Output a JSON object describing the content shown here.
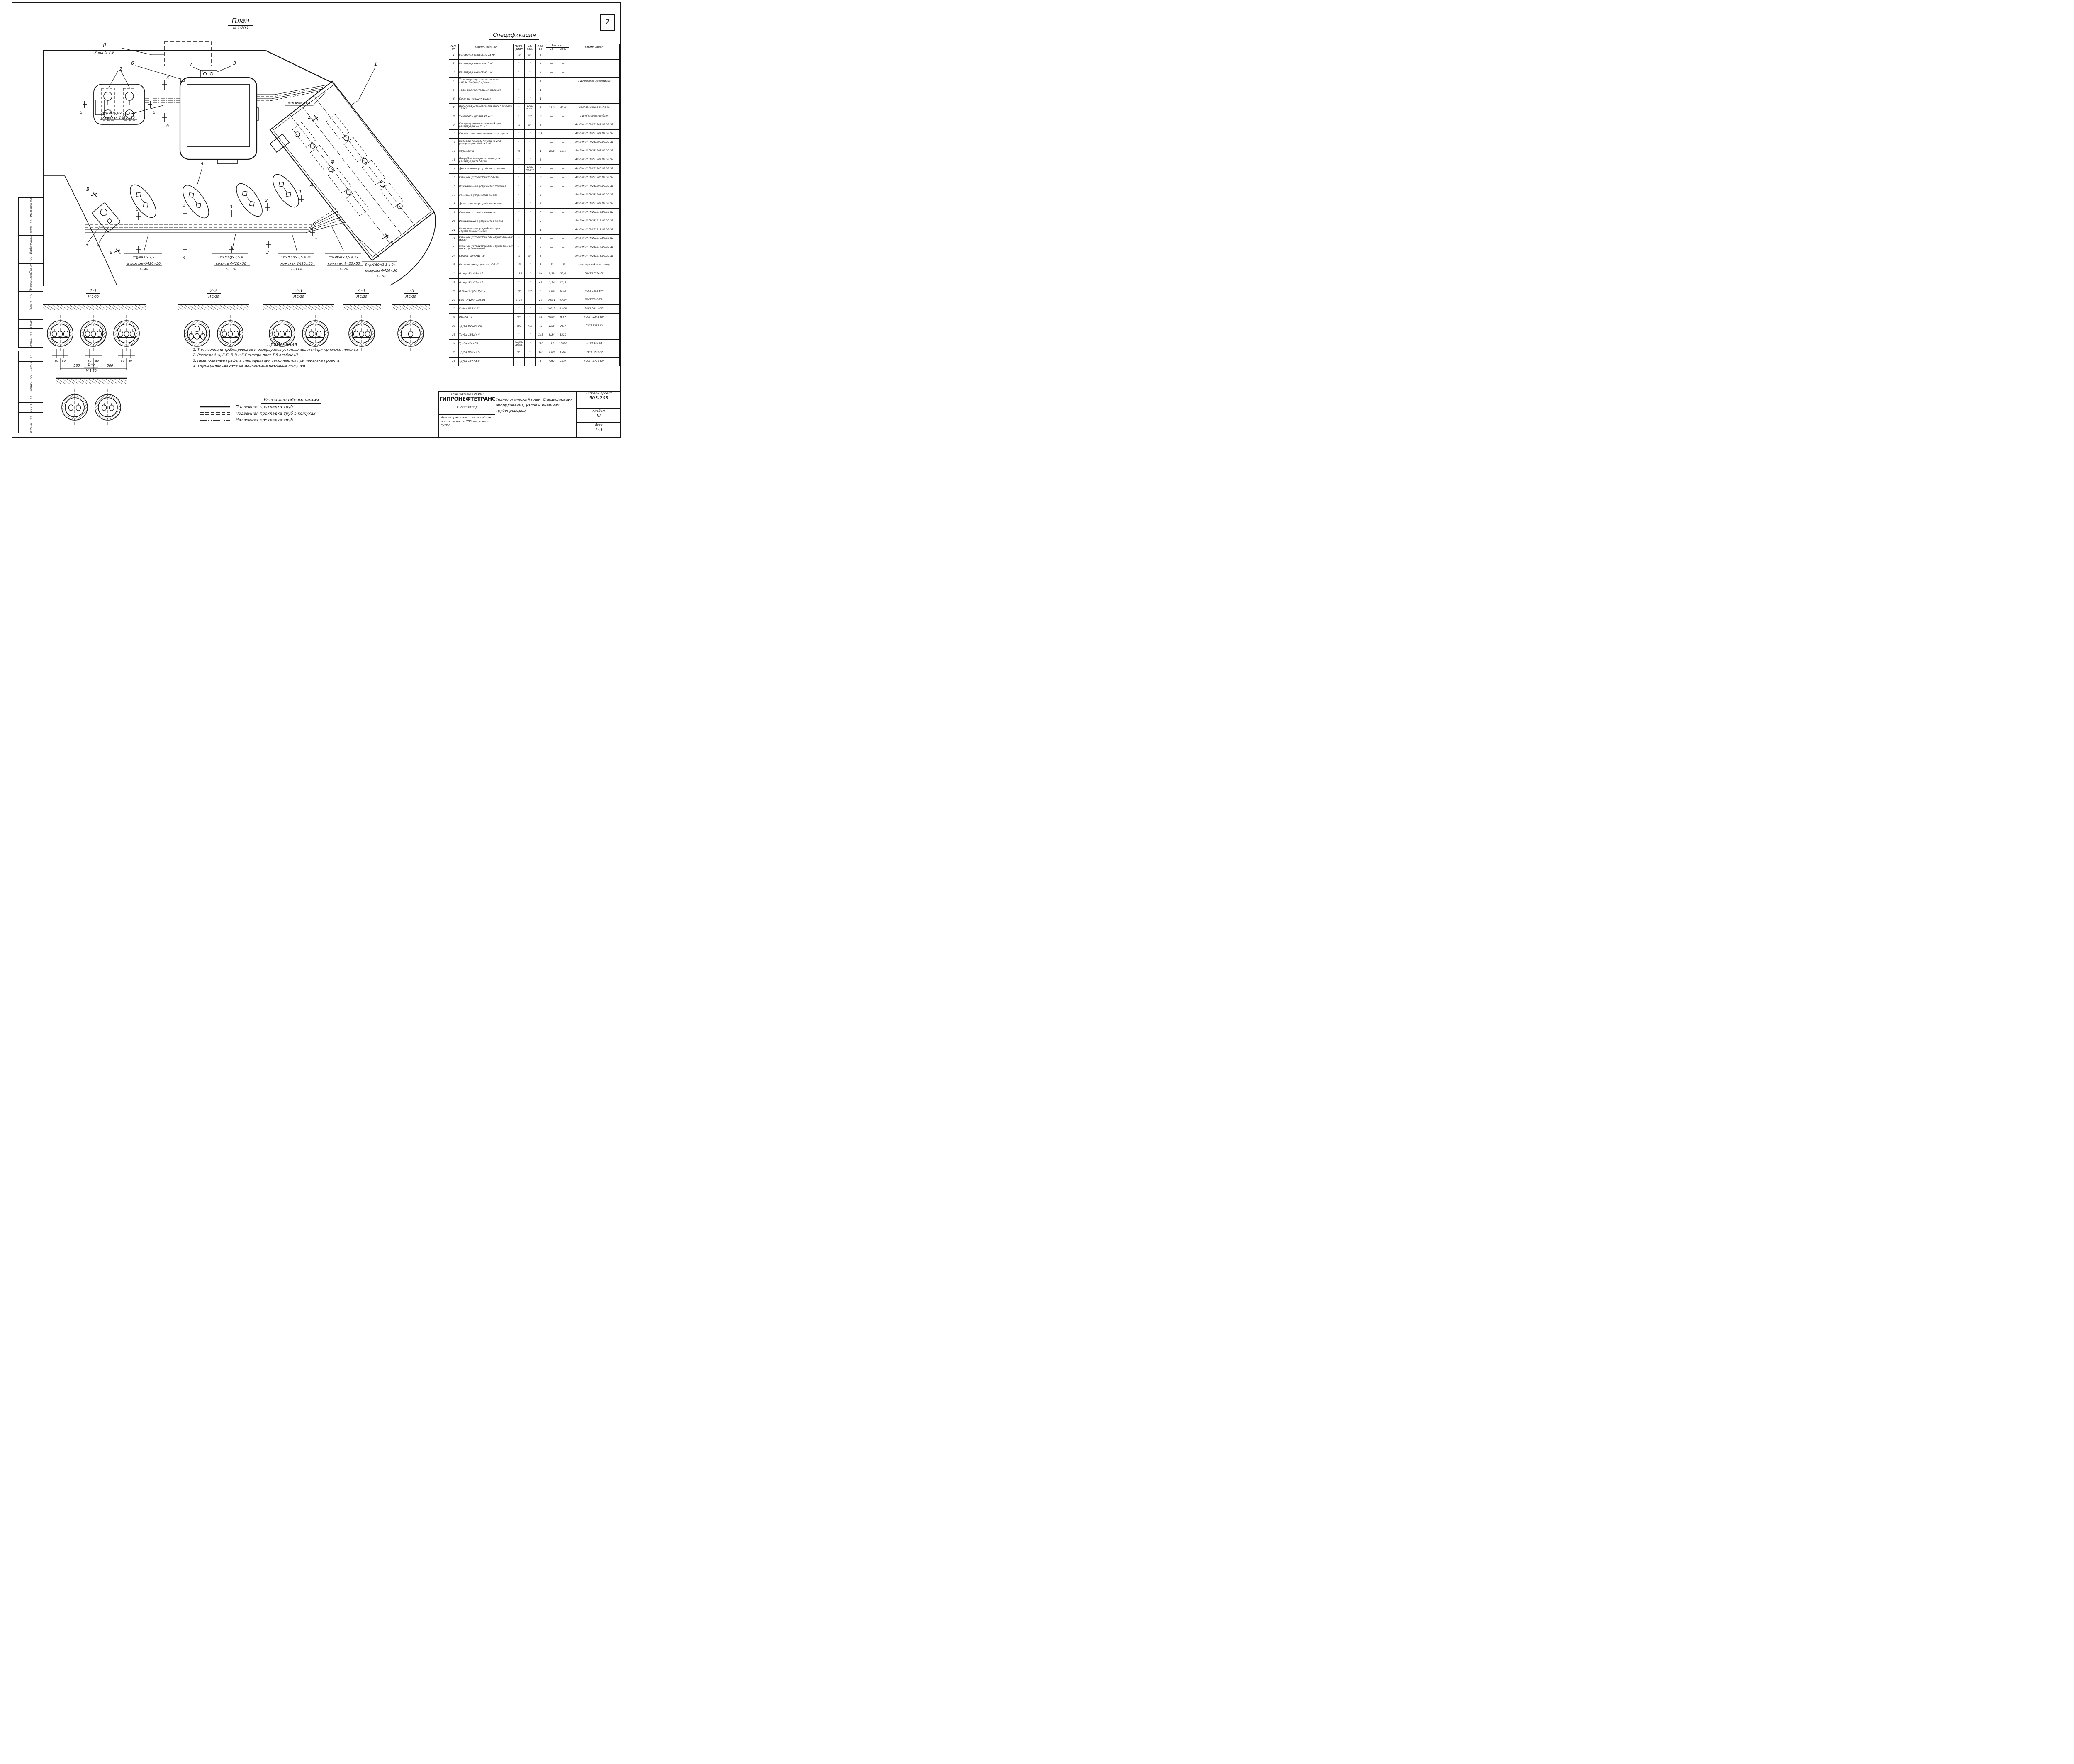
{
  "page": {
    "number": "7"
  },
  "plan": {
    "title": "План",
    "scale": "М 1:200",
    "zone": {
      "num": "II",
      "name": "Зона А, Г-Б"
    },
    "labels": {
      "tr4_1": "4тр.Ф26,8×2,8 в 2х",
      "tr4_2": "кожухах Ф420×50",
      "tr8": "8тр.Ф88,5×4",
      "tr1_1": "1тр.Ф60×3,5",
      "tr1_2": "в кожухе Ф420×50",
      "tr1_3": "ℓ=9м",
      "tr3_1": "3тр Ф60×3,5 в",
      "tr3_2": "кожухе Ф420×50",
      "tr3_3": "ℓ=11м",
      "tr5_1": "5тр Ф60×3,5 в 2х",
      "tr5_2": "кожухах Ф420×50",
      "tr5_3": "ℓ=11м",
      "tr7_1": "7тр.Ф60×3,5 в 2х",
      "tr7_2": "кожухах Ф420×50",
      "tr7_3": "ℓ=7м",
      "tr9_1": "9тр.Ф60×3,5 в 2х",
      "tr9_2": "кожухах Ф420×50",
      "tr9_3": "ℓ=7м"
    },
    "callouts": {
      "n1": "1",
      "n2": "2",
      "n3": "3",
      "n4": "4",
      "n5": "5",
      "n6": "6",
      "n7": "7"
    },
    "markers": {
      "a": "А",
      "b": "Б",
      "v": "В",
      "d": "Д",
      "s1": "1",
      "s2": "2",
      "s3": "3",
      "s4": "4",
      "s5": "5",
      "s6": "6"
    }
  },
  "sections": [
    {
      "id": "1-1",
      "scale": "М 1:20",
      "casings": [
        [
          3
        ],
        [
          3
        ],
        [
          3
        ]
      ],
      "dims": {
        "pair": [
          "80",
          "80"
        ],
        "span": "580"
      }
    },
    {
      "id": "2-2",
      "scale": "М 1:20",
      "casings": [
        [
          1,
          3
        ],
        [
          3
        ]
      ]
    },
    {
      "id": "3-3",
      "scale": "М 1:20",
      "casings": [
        [
          3
        ],
        [
          2
        ]
      ]
    },
    {
      "id": "4-4",
      "scale": "М 1:20",
      "casings": [
        [
          3
        ]
      ]
    },
    {
      "id": "5-5",
      "scale": "М 1:20",
      "casings": [
        [
          1
        ]
      ]
    },
    {
      "id": "6-6",
      "scale": "М 1:20",
      "casings": [
        [
          2
        ],
        [
          2
        ]
      ]
    }
  ],
  "notes": {
    "title": "Примечания",
    "items": [
      "1. Тип изоляции трубопроводов и резервуаров устанавливается при привязке проекта.",
      "2. Разрезы А-А, Б-Б, В-В и Г-Г смотри лист Т-5 альбом I/1.",
      "3. Незаполненые графы в спецификации заполняются при привязке проекта.",
      "4. Трубы укладываются на монолитные бетонные подушки."
    ]
  },
  "legend": {
    "title": "Условные обозначения",
    "items": [
      {
        "style": "solid",
        "label": "Подземная прокладка труб"
      },
      {
        "style": "dashed2",
        "label": "Подземная прокладка труб в кожухах."
      },
      {
        "style": "dashdot",
        "label": "Надземная прокладка труб"
      }
    ]
  },
  "spec": {
    "title": "Спецификация",
    "headers": {
      "num": "№№ пп",
      "name": "Наименование",
      "mat": "Мате-риал",
      "unit": "Ед. изм.",
      "qty": "Кол-во",
      "weight": "Вес в кг",
      "w_ed": "Ед",
      "w_tot": "Общ",
      "note": "Примечание"
    },
    "rows": [
      [
        "1",
        "Резервуар емкостью 25 м³",
        "сб",
        "шт",
        "8",
        "—",
        "—",
        ""
      ],
      [
        "2",
        "Резервуар емкостью 5 м³",
        "″",
        "″",
        "4",
        "—",
        "—",
        ""
      ],
      [
        "3",
        "Резервуар емкостью 3 м³",
        "″",
        "″",
        "2",
        "—",
        "—",
        ""
      ],
      [
        "4",
        "Топливораздаточная колонка «НАРА-2» Q=40 л/мин",
        "″",
        "″",
        "8",
        "—",
        "—",
        "з-д Нефтеаппаратприбор"
      ],
      [
        "5",
        "Топливосмесительная колонка",
        "″",
        "″",
        "1",
        "—",
        "—",
        ""
      ],
      [
        "6",
        "Колонка «воздух-вода»",
        "″",
        "″",
        "1",
        "—",
        "—",
        ""
      ],
      [
        "7",
        "Насосная установка для масел модели 3106А",
        "″",
        "ком-плект",
        "1",
        "63.0",
        "63.0",
        "Череповецкий з-д «ГАРО»"
      ],
      [
        "8",
        "Указатель уровня УДУ-10",
        "″",
        "шт",
        "8",
        "—",
        "—",
        "з-д «Старорусприбор»"
      ],
      [
        "9",
        "Колодец технологический для резервуара V=25 м³",
        "ст",
        "шт",
        "8",
        "—",
        "—",
        "Альбом IV ТМ263201.00.00 СБ"
      ],
      [
        "10",
        "Крышка технологического колодца",
        "″",
        "″",
        "13",
        "—",
        "—",
        "Альбом IV ТМ263201.03.00 СБ"
      ],
      [
        "11",
        "Колодец технологический для резервуаров V=5 и 3 м³",
        "″",
        "″",
        "5",
        "—",
        "—",
        "Альбом IV ТМ263202.00.00 СБ"
      ],
      [
        "12",
        "Стремянка",
        "сб",
        "″",
        "1",
        "19,6",
        "19,6",
        "Альбом IV ТМ263203.00.00 СБ"
      ],
      [
        "13",
        "Патрубок замерного люка для резервуара топлива",
        "″",
        "″",
        "8",
        "—",
        "—",
        "Альбом IV ТМ263204.00.00 СБ"
      ],
      [
        "14",
        "Дыхательное устройство топлива",
        "″",
        "ком-плект",
        "8",
        "—",
        "—",
        "Альбом IV ТМ263205.00.00 СБ"
      ],
      [
        "15",
        "Сливное устройство топлива",
        "″",
        "″",
        "8",
        "—",
        "—",
        "Альбом IV ТМ263206.00.00 СБ"
      ],
      [
        "16",
        "Всасывающее устройство топлива",
        "″",
        "″",
        "9",
        "—",
        "—",
        "Альбом IV ТМ263207.00.00 СБ"
      ],
      [
        "17",
        "Замерное устройство масла",
        "″",
        "″",
        "6",
        "—",
        "—",
        "Альбом IV ТМ263208.00.00 СБ"
      ],
      [
        "18",
        "Дыхательное устройство масла",
        "″",
        "″",
        "6",
        "—",
        "—",
        "Альбом IV ТМ263209.00.00 СБ"
      ],
      [
        "19",
        "Сливное устройство масла",
        "″",
        "″",
        "5",
        "—",
        "—",
        "Альбом IV ТМ263210.00.00 СБ"
      ],
      [
        "20",
        "Всасывающее устройство масла",
        "″",
        "″",
        "5",
        "—",
        "—",
        "Альбом IV ТМ263211.00.00 СБ"
      ],
      [
        "21",
        "Всасывающее устройство для отработанных масел",
        "″",
        "″",
        "1",
        "—",
        "—",
        "Альбом IV ТМ263212.00.00 СБ"
      ],
      [
        "22",
        "Сливное устройство для отработанных масел",
        "″",
        "″",
        "1",
        "—",
        "—",
        "Альбом IV ТМ263213.00.00 СБ"
      ],
      [
        "23",
        "Сливное устройство для отработанных масел (шарнирное)",
        "″",
        "″",
        "2",
        "—",
        "—",
        "Альбом IV ТМ263214.00.00 СБ"
      ],
      [
        "24",
        "Кронштейн УДУ-10",
        "ст",
        "шт",
        "8",
        "—",
        "—",
        "Альбом IV ТМ263218.00.00 СБ"
      ],
      [
        "25",
        "Огневой преградитель ОП-50",
        "сб",
        "″",
        "3",
        "5",
        "15",
        "Армавирский маш. завод"
      ],
      [
        "26",
        "Отвод 90°-89×3,5",
        "ст20",
        "″",
        "24",
        "1,39",
        "33,4",
        "ГОСТ 17374-72"
      ],
      [
        "27",
        "Отвод 90°-57×3,5",
        "″",
        "″",
        "49",
        "0,54",
        "26,5",
        "″"
      ],
      [
        "28",
        "Фланец Ду50 Ру2,5",
        "ст",
        "шт",
        "6",
        "1,04",
        "6,24",
        "ГОСТ 1255-67*"
      ],
      [
        "29",
        "Болт М12×40.38.01",
        "ст20",
        "″",
        "24",
        "0,051",
        "0,724",
        "ГОСТ 7798-70*"
      ],
      [
        "30",
        "Гайка М12.5.01",
        "″",
        "″",
        "24",
        "0,017",
        "0,408",
        "ГОСТ 5915-70*"
      ],
      [
        "31",
        "Шайба 12",
        "ст0",
        "″",
        "24",
        "0,005",
        "0,12",
        "ГОСТ 11371-68*"
      ],
      [
        "32",
        "Труба Ф26,8×2,8",
        "ст3",
        "п.м",
        "45",
        "1,66",
        "74,7",
        "ГОСТ 3262-62"
      ],
      [
        "33",
        "Труба Ф88,5×4",
        "″",
        "″",
        "145",
        "8,34",
        "1210",
        "″"
      ],
      [
        "34",
        "Труба 420×50",
        "желе-зобет.",
        "″",
        "110",
        "127",
        "13970",
        "ТУ-08-162-64"
      ],
      [
        "35",
        "Труба Ф60×3,5",
        "ст3",
        "″",
        "320",
        "4,88",
        "1562",
        "ГОСТ 3262-62"
      ],
      [
        "36",
        "Труба Ф57×3,5",
        "″",
        "″",
        "3",
        "4,62",
        "14,0",
        "ГОСТ 10704-63*"
      ]
    ]
  },
  "titleblock": {
    "dept": "Главнефтеснаб РСФСР",
    "org": "ГИПРОНЕФТЕТРАНС",
    "city": "г. Волгоград",
    "object": "Автозаправочная станция общего пользования на 750 заправок в сутки",
    "doc_title": "Технологический план. Спецификация оборудования, узлов и внешних трубопроводов",
    "project_label": "Типовой проект",
    "project": "503-203",
    "album_label": "Альбом",
    "album": "III",
    "sheet_label": "Лист",
    "sheet": "Т-3"
  },
  "stamp": {
    "sig": "∿∿",
    "people": [
      {
        "role": "Ст.инженер",
        "name": "Косолапов",
        "check": ""
      },
      {
        "role": "Инженер",
        "name": "Ефимов",
        "check": "Пирыкелова"
      },
      {
        "role": "Техник",
        "name": "Щербин",
        "check": "Курылева"
      },
      {
        "role": "Ст.техник",
        "name": "Каменский",
        "check": "Костенко"
      }
    ],
    "approvers": [
      {
        "role": "Гл.инж.пр-та"
      },
      {
        "role": "Нач.отд-а"
      },
      {
        "role": "Гл.специал."
      },
      {
        "role": "Нач.сектора"
      }
    ]
  }
}
